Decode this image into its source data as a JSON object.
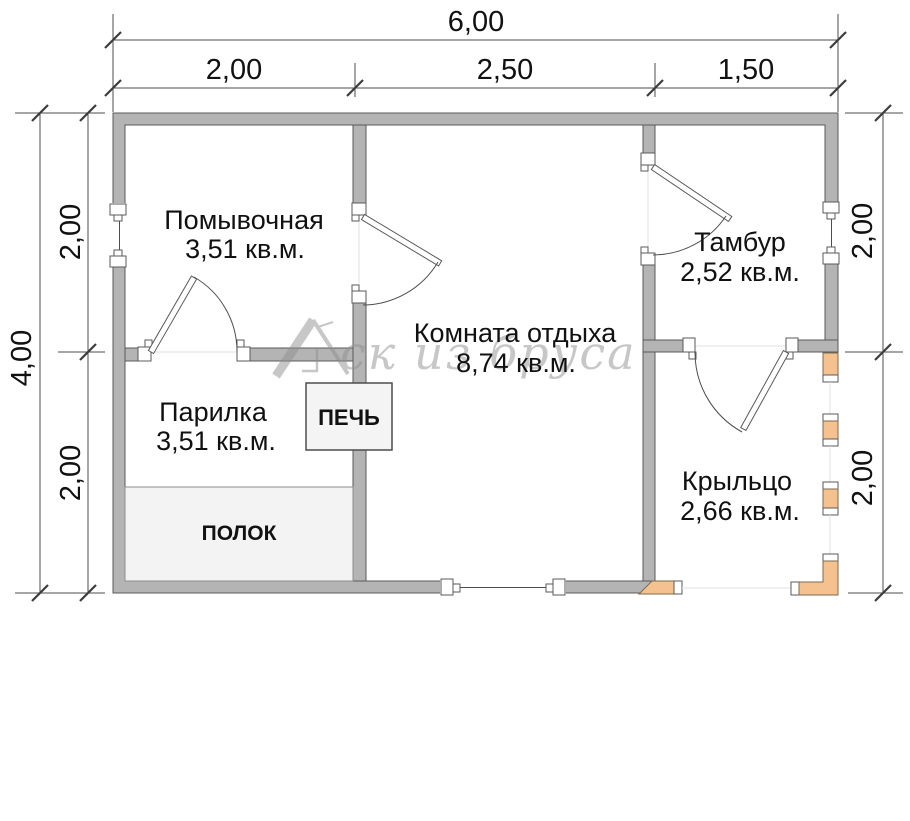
{
  "plan": {
    "watermark": {
      "text": "ск из бруса",
      "icon": "house-roof-icon"
    },
    "dimensions": {
      "top": {
        "total": "6,00",
        "segments": [
          "2,00",
          "2,50",
          "1,50"
        ]
      },
      "left": {
        "total": "4,00",
        "segments": [
          "2,00",
          "2,00"
        ]
      },
      "right": {
        "segments": [
          "2,00",
          "2,00"
        ]
      }
    },
    "rooms": [
      {
        "name": "Помывочная",
        "area": "3,51 кв.м."
      },
      {
        "name": "Парилка",
        "area": "3,51 кв.м."
      },
      {
        "name": "Комната отдыха",
        "area": "8,74 кв.м."
      },
      {
        "name": "Тамбур",
        "area": "2,52 кв.м."
      },
      {
        "name": "Крыльцо",
        "area": "2,66 кв.м."
      }
    ],
    "fixtures": {
      "stove": "ПЕЧЬ",
      "bench": "ПОЛОК"
    },
    "colors": {
      "wall": "#b4b4b4",
      "wall_outline": "#5a5a5a",
      "wood_post": "#f4c18f",
      "fixture_fill": "#f3f3f3",
      "dim_line": "#4d4d4d",
      "label_text": "#111111",
      "watermark": "#909090"
    }
  }
}
